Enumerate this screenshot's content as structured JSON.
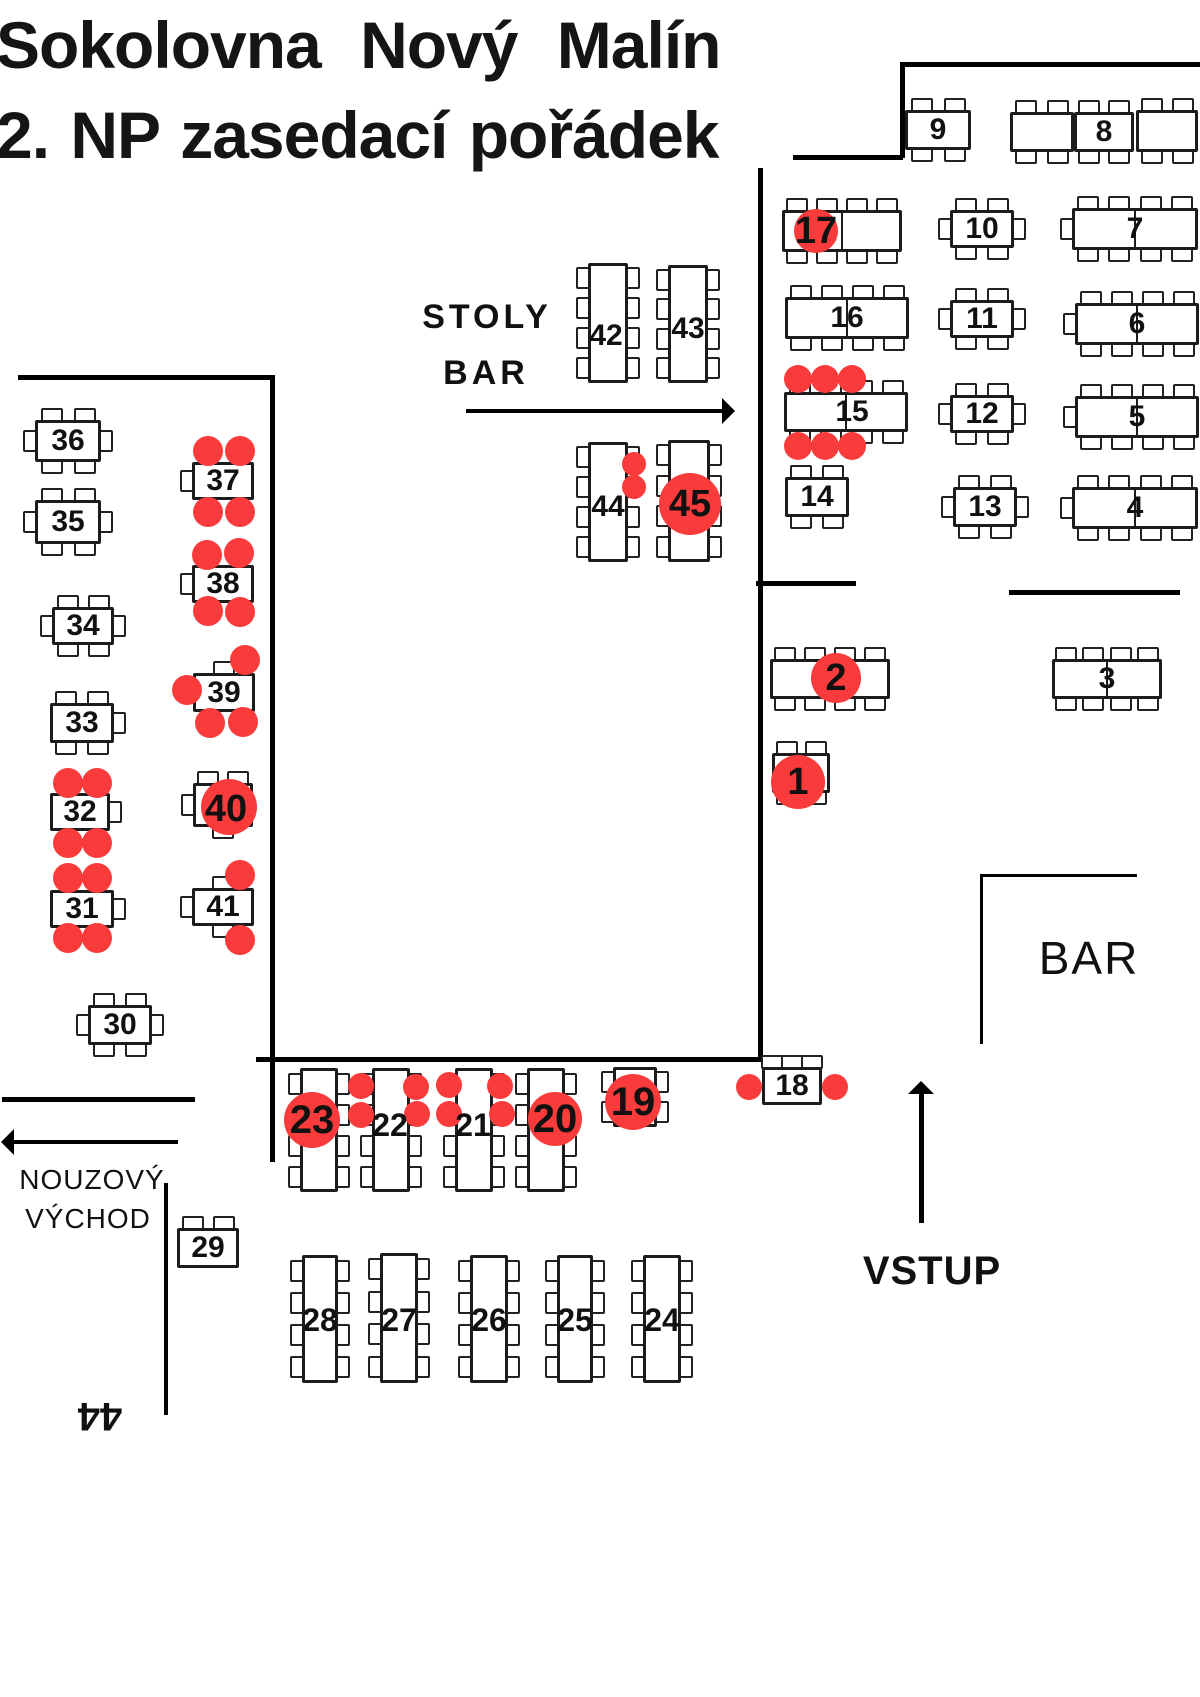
{
  "title": {
    "line1": "Sokolovna  Nový  Malín",
    "line2": "2. NP zasedací pořádek"
  },
  "colors": {
    "person": "#f93b3b",
    "wall": "#000000",
    "table_border": "#1c1c1c",
    "table_fill": "#ffffff",
    "text": "#111111"
  },
  "canvas": {
    "width": 1200,
    "height": 1697
  },
  "floor": {
    "walls": [
      {
        "x": 900,
        "y": 62,
        "w": 300,
        "h": 5
      },
      {
        "x": 900,
        "y": 62,
        "w": 5,
        "h": 96
      },
      {
        "x": 793,
        "y": 155,
        "w": 110,
        "h": 5
      },
      {
        "x": 758,
        "y": 168,
        "w": 5,
        "h": 892
      },
      {
        "x": 18,
        "y": 375,
        "w": 252,
        "h": 5
      },
      {
        "x": 270,
        "y": 375,
        "w": 5,
        "h": 787
      },
      {
        "x": 256,
        "y": 1057,
        "w": 556,
        "h": 5
      },
      {
        "x": 756,
        "y": 581,
        "w": 100,
        "h": 5
      },
      {
        "x": 1009,
        "y": 590,
        "w": 171,
        "h": 5
      },
      {
        "x": 980,
        "y": 874,
        "w": 157,
        "h": 3
      },
      {
        "x": 980,
        "y": 874,
        "w": 3,
        "h": 170
      },
      {
        "x": 2,
        "y": 1097,
        "w": 193,
        "h": 5
      },
      {
        "x": 164,
        "y": 1183,
        "w": 4,
        "h": 232
      }
    ],
    "arrows": [
      {
        "name": "stoly-bar-arrow",
        "x": 466,
        "y": 411,
        "len": 258,
        "dir": "right",
        "t": 4
      },
      {
        "name": "emergency-exit-arrow",
        "x": 12,
        "y": 1142,
        "len": 166,
        "dir": "left",
        "t": 4
      },
      {
        "name": "vstup-arrow",
        "x": 921,
        "y": 1092,
        "len": 131,
        "dir": "up",
        "t": 5
      }
    ],
    "texts": [
      {
        "name": "stoly-label",
        "text": "STOLY",
        "x": 487,
        "y": 317,
        "fs": 34,
        "fw": 800,
        "ls": 4
      },
      {
        "name": "stoly-bar-label",
        "text": "BAR",
        "x": 486,
        "y": 373,
        "fs": 34,
        "fw": 800,
        "ls": 4
      },
      {
        "name": "bar-label",
        "text": "BAR",
        "x": 1089,
        "y": 958,
        "fs": 46,
        "fw": 400,
        "ls": 2
      },
      {
        "name": "vstup-label",
        "text": "VSTUP",
        "x": 932,
        "y": 1271,
        "fs": 40,
        "fw": 800,
        "ls": 1
      },
      {
        "name": "emergency-exit-label-line1",
        "text": "NOUZOVÝ",
        "x": 92,
        "y": 1180,
        "fs": 28,
        "fw": 400,
        "ls": 1
      },
      {
        "name": "emergency-exit-label-line2",
        "text": "VÝCHOD",
        "x": 88,
        "y": 1219,
        "fs": 28,
        "fw": 400,
        "ls": 1
      },
      {
        "name": "rotated-44-label",
        "text": "44",
        "x": 100,
        "y": 1416,
        "fs": 40,
        "fw": 800,
        "rot": 180
      }
    ],
    "tables": [
      {
        "id": "9",
        "x": 905,
        "y": 110,
        "w": 66,
        "h": 40,
        "ch": {
          "t": 2,
          "b": 2
        }
      },
      {
        "id": "",
        "x": 1010,
        "y": 112,
        "w": 64,
        "h": 40,
        "ch": {
          "t": 2,
          "b": 2
        }
      },
      {
        "id": "8",
        "x": 1074,
        "y": 112,
        "w": 60,
        "h": 40,
        "ch": {
          "t": 2,
          "b": 2
        }
      },
      {
        "id": "",
        "x": 1136,
        "y": 110,
        "w": 62,
        "h": 42,
        "ch": {
          "t": 2,
          "b": 2
        }
      },
      {
        "id": "17",
        "x": 782,
        "y": 210,
        "w": 120,
        "h": 42,
        "ch": {
          "t": 4,
          "b": 4
        },
        "div": 1,
        "circle": {
          "cx": 816,
          "cy": 231,
          "r": 22
        },
        "lp": [
          816,
          231
        ],
        "fs": 38
      },
      {
        "id": "10",
        "x": 950,
        "y": 210,
        "w": 64,
        "h": 38,
        "ch": {
          "t": 2,
          "b": 2,
          "l": 1,
          "r": 1
        }
      },
      {
        "id": "7",
        "x": 1072,
        "y": 208,
        "w": 126,
        "h": 42,
        "ch": {
          "t": 4,
          "b": 4,
          "l": 1
        },
        "div": 1
      },
      {
        "id": "16",
        "x": 785,
        "y": 297,
        "w": 124,
        "h": 42,
        "ch": {
          "t": 4,
          "b": 4
        },
        "div": 1
      },
      {
        "id": "11",
        "x": 950,
        "y": 300,
        "w": 64,
        "h": 38,
        "ch": {
          "t": 2,
          "b": 2,
          "l": 1,
          "r": 1
        }
      },
      {
        "id": "6",
        "x": 1075,
        "y": 303,
        "w": 124,
        "h": 42,
        "ch": {
          "t": 4,
          "b": 4,
          "l": 1
        },
        "div": 1
      },
      {
        "id": "15",
        "x": 784,
        "y": 392,
        "w": 124,
        "h": 40,
        "ch": {
          "t": 4,
          "b": 4
        },
        "div": 1,
        "lp": [
          852,
          412
        ],
        "dots": [
          [
            798,
            379
          ],
          [
            825,
            379
          ],
          [
            852,
            379
          ],
          [
            798,
            446
          ],
          [
            825,
            446
          ],
          [
            852,
            446
          ]
        ],
        "dr": 14
      },
      {
        "id": "12",
        "x": 950,
        "y": 395,
        "w": 64,
        "h": 38,
        "ch": {
          "t": 2,
          "b": 2,
          "l": 1,
          "r": 1
        }
      },
      {
        "id": "5",
        "x": 1075,
        "y": 396,
        "w": 124,
        "h": 42,
        "ch": {
          "t": 4,
          "b": 4,
          "l": 1
        },
        "div": 1
      },
      {
        "id": "14",
        "x": 785,
        "y": 477,
        "w": 64,
        "h": 40,
        "ch": {
          "t": 2,
          "b": 2
        }
      },
      {
        "id": "13",
        "x": 953,
        "y": 487,
        "w": 64,
        "h": 40,
        "ch": {
          "t": 2,
          "b": 2,
          "l": 1,
          "r": 1
        }
      },
      {
        "id": "4",
        "x": 1072,
        "y": 487,
        "w": 126,
        "h": 42,
        "ch": {
          "t": 4,
          "b": 4,
          "l": 1
        },
        "div": 1
      },
      {
        "id": "2",
        "x": 770,
        "y": 659,
        "w": 120,
        "h": 40,
        "ch": {
          "t": 4,
          "b": 4
        },
        "div": 1,
        "circle": {
          "cx": 836,
          "cy": 678,
          "r": 25
        },
        "lp": [
          836,
          678
        ],
        "fs": 38
      },
      {
        "id": "3",
        "x": 1052,
        "y": 659,
        "w": 110,
        "h": 40,
        "ch": {
          "t": 4,
          "b": 4
        },
        "div": 1
      },
      {
        "id": "1",
        "x": 772,
        "y": 753,
        "w": 58,
        "h": 40,
        "ch": {
          "t": 2,
          "b": 2
        },
        "circle": {
          "cx": 798,
          "cy": 782,
          "r": 27
        },
        "lp": [
          798,
          782
        ],
        "fs": 38
      },
      {
        "id": "42",
        "x": 588,
        "y": 263,
        "w": 40,
        "h": 120,
        "ch": {
          "l": 4,
          "r": 4
        },
        "lp": [
          606,
          336
        ]
      },
      {
        "id": "43",
        "x": 668,
        "y": 265,
        "w": 40,
        "h": 118,
        "ch": {
          "l": 4,
          "r": 4
        },
        "lp": [
          688,
          329
        ]
      },
      {
        "id": "44",
        "x": 588,
        "y": 442,
        "w": 40,
        "h": 120,
        "ch": {
          "l": 4,
          "r": 4
        },
        "lp": [
          608,
          507
        ],
        "dots": [
          [
            634,
            464
          ],
          [
            634,
            487
          ]
        ],
        "dr": 12
      },
      {
        "id": "45",
        "x": 668,
        "y": 440,
        "w": 42,
        "h": 122,
        "ch": {
          "l": 4,
          "r": 4
        },
        "circle": {
          "cx": 690,
          "cy": 504,
          "r": 31
        },
        "lp": [
          690,
          504
        ],
        "fs": 38
      },
      {
        "id": "36",
        "x": 35,
        "y": 420,
        "w": 66,
        "h": 42,
        "ch": {
          "t": 2,
          "b": 2,
          "l": 1,
          "r": 1
        }
      },
      {
        "id": "35",
        "x": 35,
        "y": 500,
        "w": 66,
        "h": 44,
        "ch": {
          "t": 2,
          "b": 2,
          "l": 1,
          "r": 1
        }
      },
      {
        "id": "37",
        "x": 192,
        "y": 462,
        "w": 62,
        "h": 38,
        "ch": {
          "l": 1
        },
        "dots": [
          [
            208,
            451
          ],
          [
            240,
            451
          ],
          [
            208,
            512
          ],
          [
            240,
            512
          ]
        ],
        "dr": 15
      },
      {
        "id": "38",
        "x": 192,
        "y": 565,
        "w": 62,
        "h": 38,
        "ch": {
          "l": 1
        },
        "dots": [
          [
            207,
            555
          ],
          [
            239,
            553
          ],
          [
            208,
            611
          ],
          [
            240,
            612
          ]
        ],
        "dr": 15
      },
      {
        "id": "34",
        "x": 52,
        "y": 607,
        "w": 62,
        "h": 38,
        "ch": {
          "t": 2,
          "b": 2,
          "l": 1,
          "r": 1
        }
      },
      {
        "id": "39",
        "x": 193,
        "y": 673,
        "w": 62,
        "h": 39,
        "ch": {
          "t": 1
        },
        "dots": [
          [
            245,
            660
          ],
          [
            187,
            690
          ],
          [
            210,
            723
          ],
          [
            243,
            722
          ]
        ],
        "dr": 15
      },
      {
        "id": "33",
        "x": 50,
        "y": 703,
        "w": 64,
        "h": 40,
        "ch": {
          "t": 2,
          "b": 2,
          "r": 1
        }
      },
      {
        "id": "32",
        "x": 50,
        "y": 793,
        "w": 60,
        "h": 38,
        "ch": {
          "r": 1
        },
        "dots": [
          [
            68,
            783
          ],
          [
            97,
            783
          ],
          [
            68,
            843
          ],
          [
            97,
            843
          ]
        ],
        "dr": 15
      },
      {
        "id": "40",
        "x": 193,
        "y": 783,
        "w": 60,
        "h": 44,
        "ch": {
          "t": 2,
          "b": 1,
          "l": 1
        },
        "circle": {
          "cx": 229,
          "cy": 807,
          "r": 28
        },
        "lp": [
          226,
          809
        ],
        "fs": 38
      },
      {
        "id": "31",
        "x": 50,
        "y": 890,
        "w": 64,
        "h": 38,
        "ch": {
          "r": 1
        },
        "dots": [
          [
            68,
            878
          ],
          [
            97,
            878
          ],
          [
            68,
            938
          ],
          [
            97,
            938
          ]
        ],
        "dr": 15
      },
      {
        "id": "41",
        "x": 192,
        "y": 888,
        "w": 62,
        "h": 38,
        "ch": {
          "t": 1,
          "b": 1,
          "l": 1
        },
        "dots": [
          [
            240,
            875
          ],
          [
            240,
            940
          ]
        ],
        "dr": 15
      },
      {
        "id": "30",
        "x": 88,
        "y": 1005,
        "w": 64,
        "h": 40,
        "ch": {
          "t": 2,
          "b": 2,
          "l": 1,
          "r": 1
        }
      },
      {
        "id": "23",
        "x": 300,
        "y": 1068,
        "w": 38,
        "h": 124,
        "ch": {
          "l": 4,
          "r": 4
        },
        "circle": {
          "cx": 312,
          "cy": 1120,
          "r": 28
        },
        "lp": [
          312,
          1120
        ],
        "fs": 40
      },
      {
        "id": "22",
        "x": 372,
        "y": 1068,
        "w": 38,
        "h": 124,
        "ch": {
          "l": 4,
          "r": 4
        },
        "lp": [
          390,
          1125
        ],
        "fs": 32,
        "dots": [
          [
            361,
            1086
          ],
          [
            361,
            1115
          ],
          [
            416,
            1087
          ],
          [
            417,
            1114
          ]
        ],
        "dr": 13
      },
      {
        "id": "21",
        "x": 455,
        "y": 1068,
        "w": 38,
        "h": 124,
        "ch": {
          "l": 4,
          "r": 4
        },
        "lp": [
          473,
          1125
        ],
        "fs": 32,
        "dots": [
          [
            449,
            1085
          ],
          [
            449,
            1114
          ],
          [
            500,
            1086
          ],
          [
            502,
            1114
          ]
        ],
        "dr": 13
      },
      {
        "id": "20",
        "x": 527,
        "y": 1068,
        "w": 38,
        "h": 124,
        "ch": {
          "l": 4,
          "r": 4
        },
        "circle": {
          "cx": 555,
          "cy": 1119,
          "r": 27
        },
        "lp": [
          555,
          1119
        ],
        "fs": 40
      },
      {
        "id": "19",
        "x": 613,
        "y": 1067,
        "w": 44,
        "h": 60,
        "ch": {
          "l": 2,
          "r": 2
        },
        "circle": {
          "cx": 633,
          "cy": 1102,
          "r": 28
        },
        "lp": [
          633,
          1102
        ],
        "fs": 40
      },
      {
        "id": "18",
        "x": 762,
        "y": 1067,
        "w": 60,
        "h": 38,
        "ch": {
          "t": 3
        },
        "dots": [
          [
            749,
            1087
          ],
          [
            835,
            1087
          ]
        ],
        "dr": 13
      },
      {
        "id": "29",
        "x": 177,
        "y": 1228,
        "w": 62,
        "h": 40,
        "ch": {
          "t": 2
        }
      },
      {
        "id": "28",
        "x": 302,
        "y": 1255,
        "w": 36,
        "h": 128,
        "ch": {
          "l": 4,
          "r": 4
        },
        "lp": [
          320,
          1320
        ],
        "fs": 32
      },
      {
        "id": "27",
        "x": 380,
        "y": 1253,
        "w": 38,
        "h": 130,
        "ch": {
          "l": 4,
          "r": 4
        },
        "lp": [
          399,
          1320
        ],
        "fs": 32
      },
      {
        "id": "26",
        "x": 470,
        "y": 1255,
        "w": 38,
        "h": 128,
        "ch": {
          "l": 4,
          "r": 4
        },
        "lp": [
          489,
          1320
        ],
        "fs": 32
      },
      {
        "id": "25",
        "x": 557,
        "y": 1255,
        "w": 36,
        "h": 128,
        "ch": {
          "l": 4,
          "r": 4
        },
        "lp": [
          575,
          1320
        ],
        "fs": 32
      },
      {
        "id": "24",
        "x": 643,
        "y": 1255,
        "w": 38,
        "h": 128,
        "ch": {
          "l": 4,
          "r": 4
        },
        "lp": [
          662,
          1320
        ],
        "fs": 32
      }
    ]
  }
}
